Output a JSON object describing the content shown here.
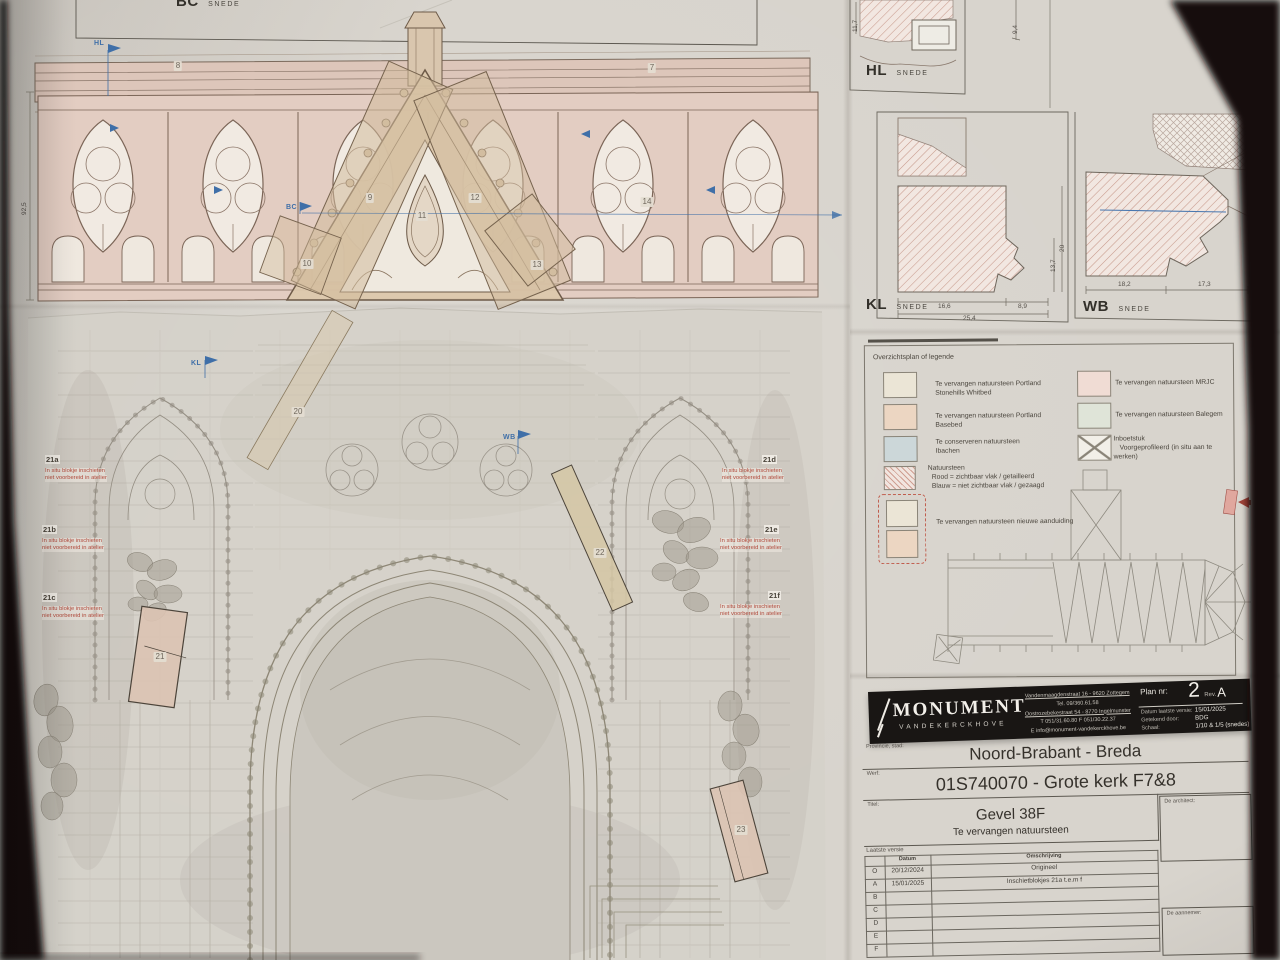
{
  "sections": {
    "bc": {
      "code": "BC",
      "word": "SNEDE"
    },
    "hl": {
      "code": "HL",
      "word": "SNEDE",
      "dim_left": "11,7",
      "dim_right": "9,4"
    },
    "kl": {
      "code": "KL",
      "word": "SNEDE",
      "dim_w1": "16,6",
      "dim_w2": "8,9",
      "dim_total": "25,4",
      "dim_h1": "13,7",
      "dim_h2": "20"
    },
    "wb": {
      "code": "WB",
      "word": "SNEDE",
      "dim_w1": "18,2",
      "dim_w2": "17,3"
    }
  },
  "elevation": {
    "dim_height": "92,5",
    "markers": {
      "hl": "HL",
      "bc": "BC",
      "kl": "KL",
      "wb": "WB"
    },
    "part_tags": [
      "7",
      "8",
      "9",
      "10",
      "11",
      "12",
      "13",
      "14",
      "20",
      "21",
      "22",
      "23"
    ],
    "notes": [
      {
        "id": "21a",
        "line1": "In situ blokje inschieten",
        "line2": "niet voorbereid in atelier"
      },
      {
        "id": "21b",
        "line1": "In situ blokje inschieten",
        "line2": "niet voorbereid in atelier"
      },
      {
        "id": "21c",
        "line1": "In situ blokje inschieten",
        "line2": "niet voorbereid in atelier"
      },
      {
        "id": "21d",
        "line1": "In situ blokje inschieten",
        "line2": "niet voorbereid in atelier"
      },
      {
        "id": "21e",
        "line1": "In situ blokje inschieten",
        "line2": "niet voorbereid in atelier"
      },
      {
        "id": "21f",
        "line1": "In situ blokje inschieten",
        "line2": "niet voorbereid in atelier"
      }
    ]
  },
  "legend": {
    "title": "Overzichtsplan of legende",
    "items": [
      {
        "label": "Te vervangen natuursteen Portland Stonehills Whitbed",
        "swatch": "#ebe5d6"
      },
      {
        "label": "Te vervangen natuursteen Portland Basebed",
        "swatch": "#ecd6c2"
      },
      {
        "label": "Te conserveren natuursteen",
        "label2": "Ibachen",
        "swatch": "#ccd7d9"
      },
      {
        "label": "Natuursteen",
        "label2": "Rood = zichtbaar vlak / getailleerd",
        "label3": "Blauw = niet zichtbaar vlak / gezaagd",
        "swatch": "hatch"
      },
      {
        "label": "Te vervangen natuursteen nieuwe aanduiding",
        "swatch": "new"
      },
      {
        "label": "Te vervangen natuursteen MRJC",
        "swatch": "#f0dcd4"
      },
      {
        "label": "Te vervangen natuursteen Balegem",
        "swatch": "#dfe4d8"
      },
      {
        "label": "Inboetstuk",
        "label2": "Voorgeprofileerd (in situ aan te werken)",
        "swatch": "cross"
      }
    ]
  },
  "titleblock": {
    "company": "MONUMENT",
    "company_sub": "VANDEKERCKHOVE",
    "address1": "Vandenmaagdenstraat 16 - 9620 Zottegem",
    "address2": "Tel. 09/360.61.58",
    "address3": "Oostrozebekestraat 54 - 8770 Ingelmunster",
    "address4": "T 051/31.60.80   F 051/30.22.37",
    "address5": "E info@monument-vandekerckhove.be",
    "plan_nr_label": "Plan nr:",
    "plan_nr": "2",
    "rev_label": "Rev.",
    "rev": "A",
    "datum_label": "Datum laatste versie:",
    "datum": "15/01/2025",
    "getekend_label": "Getekend door:",
    "getekend": "BDG",
    "schaal_label": "Schaal:",
    "schaal": "1/10 & 1/5 (snedes)"
  },
  "project": {
    "provincie_label": "Provincie, stad:",
    "provincie": "Noord-Brabant - Breda",
    "werf_label": "Werf:",
    "werf": "01S740070 - Grote kerk F7&8",
    "titel_label": "Titel:",
    "titel": "Gevel 38F",
    "subtitel": "Te vervangen natuursteen",
    "architect_label": "De architect:",
    "aannemer_label": "De aannemer:"
  },
  "revisions": {
    "caption": "Laatste versie",
    "col_datum": "Datum",
    "col_omschrijving": "Omschrijving",
    "rows": [
      {
        "code": "O",
        "datum": "20/12/2024",
        "omschrijving": "Origineel"
      },
      {
        "code": "A",
        "datum": "15/01/2025",
        "omschrijving": "Inschietblokjes 21a t.e.m f"
      },
      {
        "code": "B",
        "datum": "",
        "omschrijving": ""
      },
      {
        "code": "C",
        "datum": "",
        "omschrijving": ""
      },
      {
        "code": "D",
        "datum": "",
        "omschrijving": ""
      },
      {
        "code": "E",
        "datum": "",
        "omschrijving": ""
      },
      {
        "code": "F",
        "datum": "",
        "omschrijving": ""
      }
    ]
  },
  "colors": {
    "paper": "#d8d4cd",
    "stone_pink": "#e3cdc2",
    "stone_tan": "#dcc9ad",
    "highlight_block": "#dcc3b2",
    "note_red": "#b14a3c",
    "marker_blue": "#3f6fa8",
    "title_band": "#191614"
  }
}
